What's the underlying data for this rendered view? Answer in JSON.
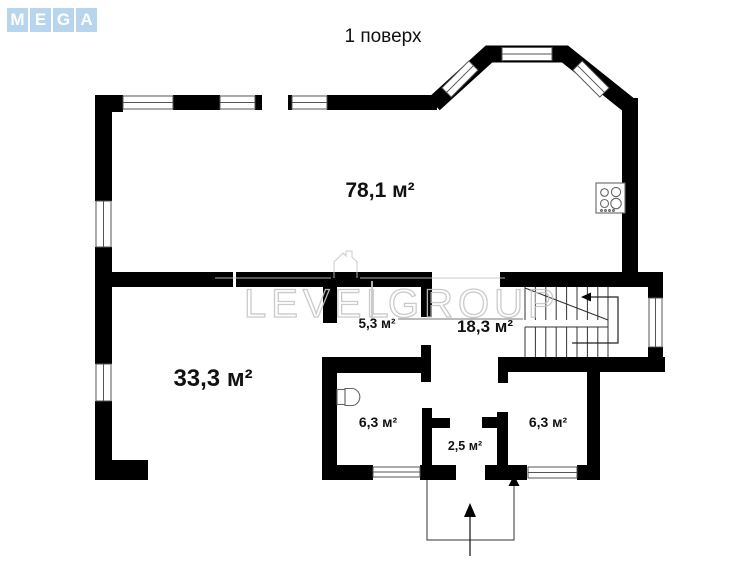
{
  "logo": {
    "letters": [
      "M",
      "E",
      "G",
      "A"
    ],
    "bg_color": "#b7d5ed"
  },
  "title": "1 поверх",
  "watermark": {
    "word_left": "LEVEL",
    "word_right": "GROUP"
  },
  "rooms": [
    {
      "name": "living-kitchen",
      "area": "78,1 м²"
    },
    {
      "name": "room",
      "area": "33,3 м²"
    },
    {
      "name": "corridor",
      "area": "5,3 м²"
    },
    {
      "name": "hall",
      "area": "18,3 м²"
    },
    {
      "name": "bathroom",
      "area": "6,3 м²"
    },
    {
      "name": "vestibule",
      "area": "2,5 м²"
    },
    {
      "name": "storage",
      "area": "6,3 м²"
    }
  ],
  "icons": {
    "stove": "stove-icon",
    "toilet": "toilet-icon",
    "staircase": "staircase-icon",
    "entrance": "entrance-arrow-icon"
  },
  "colors": {
    "wall": "#000000",
    "window_outline": "#555555",
    "watermark": "#c6c6c6",
    "logo_blue": "#b7d5ed"
  }
}
